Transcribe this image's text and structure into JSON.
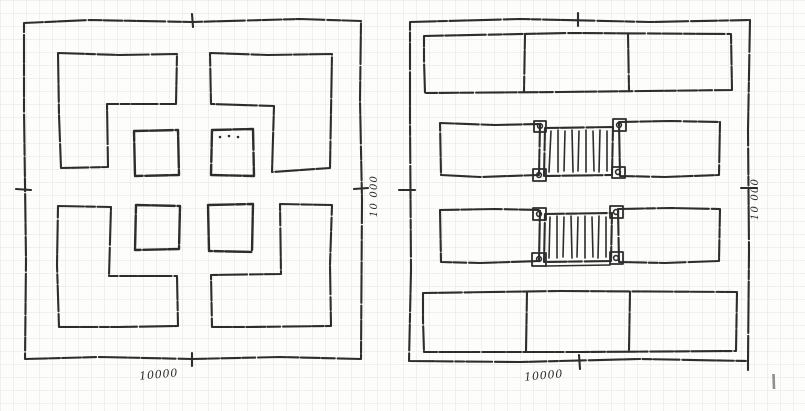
{
  "page": {
    "background_color": "#fdfdfc",
    "grid_color": "#e9e3db",
    "ink_color": "#2d2d2d"
  },
  "left_plan": {
    "bottom_dimension_label": "10000",
    "side_dimension_label": "10 000"
  },
  "right_plan": {
    "bottom_dimension_label": "10000",
    "side_dimension_label": "10 000"
  }
}
